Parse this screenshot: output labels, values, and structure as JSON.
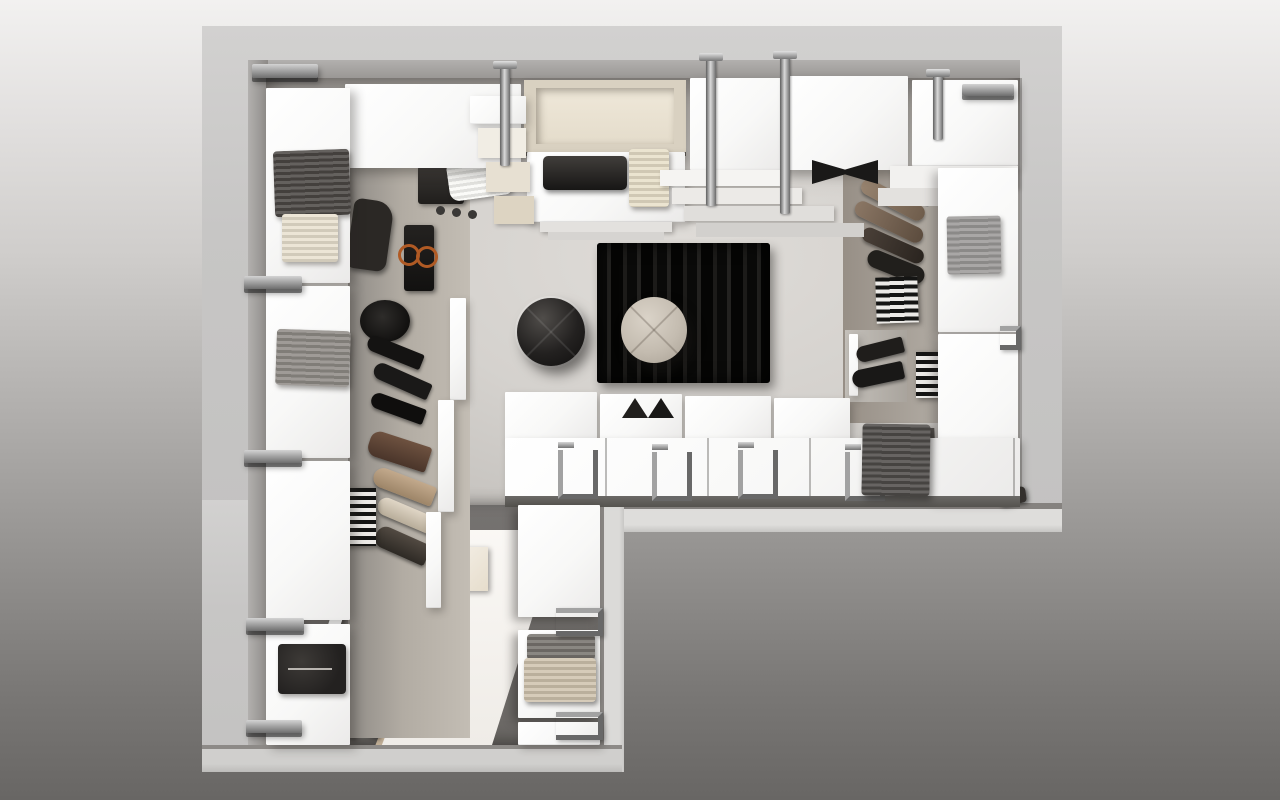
{
  "scene": {
    "description": "Photorealistic top-down 3D render of an L-shaped walk-in closet with white modular wardrobe units, shoe shelves, hanging rails, a black striped rug and two round poufs",
    "room": {
      "shape": "L-shaped, plan view, notch cut out at bottom-right",
      "text_content": "none (image contains no visible text)"
    },
    "palette": {
      "background_top": "#f2f1f0",
      "background_bottom": "#686664",
      "wall": "#c9c8c6",
      "wall_lit": "#dedddb",
      "wall_inner_face": "#8d8a87",
      "floor_main": "#d5d2ce",
      "floor_corridor": "#706d6a",
      "cabinet_white": "#fafaf9",
      "chrome": "#8f8f8f",
      "rug_black": "#0e0d0c",
      "pouf_beige": "#c8c0b4",
      "pouf_black": "#1b1a19",
      "cream": "#e8e0cd",
      "taupe": "#8a7967",
      "orange_accent": "#b05a24"
    },
    "labels": {
      "room": "L-shaped walk-in closet, top view",
      "background": "studio gradient backdrop",
      "wall": "plaster wall band",
      "wall_face": "inner wall face in shadow",
      "floor_main": "main wardrobe floor",
      "floor_corridor": "corridor floor",
      "light_streak": "skylight beam across corridor floor",
      "rug": "black striped wool rug",
      "pouf_beige": "round beige tufted pouf",
      "pouf_black": "round black leather pouf",
      "cabinet": "white wardrobe unit (top view)",
      "open_unit": "open cream storage unit",
      "dresser": "chest of drawers with tray",
      "tray": "black storage tray",
      "sweater_dark": "folded dark grey sweater",
      "towel_cream": "folded cream towel",
      "sweater_knit": "folded grey knit sweater",
      "sweater_black": "folded black sweater",
      "sweater_cream": "folded cream sweater",
      "shirt_stack": "stack of folded dark shirts",
      "shirts_white": "fanned white shirts",
      "garment_bag": "black garment bag with orange rings",
      "hat": "black round hat",
      "shoes_black": "black heeled shoes",
      "shoes_brown": "brown shoe",
      "shoes_tan": "tan shoe",
      "shoes_pair": "pair of dark shoes",
      "striped_box": "black and white striped storage box",
      "hanging_clothes": "clothes hanging from chrome rail",
      "rail": "chrome hanging rail",
      "bracket": "chrome mounting bracket",
      "hook": "chrome hanging hook",
      "towel_gray": "folded grey towel",
      "blanket": "folded dark grey blanket",
      "bin": "dark storage bin",
      "shelf_step": "staggered shelf panel",
      "divider_panels": "vertical divider panel",
      "folded_stack": "stack of folded garments",
      "bowtie_garment": "folded dark garment",
      "dark_slot": "open dark compartment"
    }
  }
}
